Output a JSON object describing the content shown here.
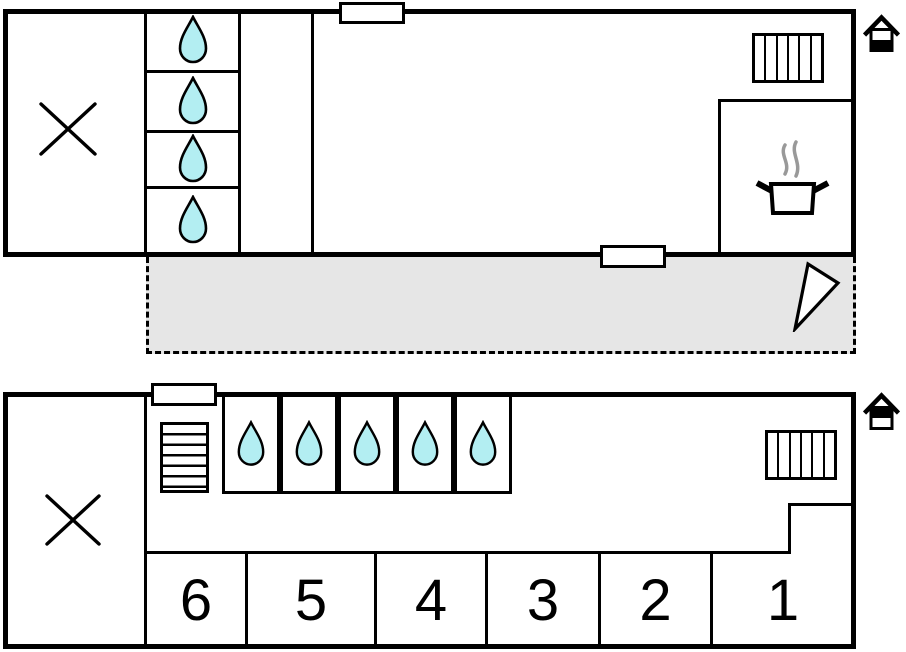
{
  "colors": {
    "wall": "#000000",
    "drop_fill": "#b3eef2",
    "terrace_fill": "#e6e6e6",
    "steam": "#999999",
    "bg": "#ffffff"
  },
  "plan_top": {
    "level_indicator_icon": "house-ground-floor-highlighted",
    "drop_cell_count": 4,
    "radiator_slat_count": 6,
    "window_count": 2,
    "symbols": [
      "x-room-marker",
      "water-drop",
      "radiator",
      "cooking-pot-with-steam",
      "terrace",
      "north-arrow-triangle"
    ]
  },
  "plan_bottom": {
    "level_indicator_icon": "house-upper-floor-highlighted",
    "drop_cell_count": 5,
    "stair_symbol": "stairs",
    "radiator_slat_count": 6,
    "window_count": 1,
    "rooms": [
      {
        "label": "6"
      },
      {
        "label": "5"
      },
      {
        "label": "4"
      },
      {
        "label": "3"
      },
      {
        "label": "2"
      },
      {
        "label": "1"
      }
    ]
  }
}
